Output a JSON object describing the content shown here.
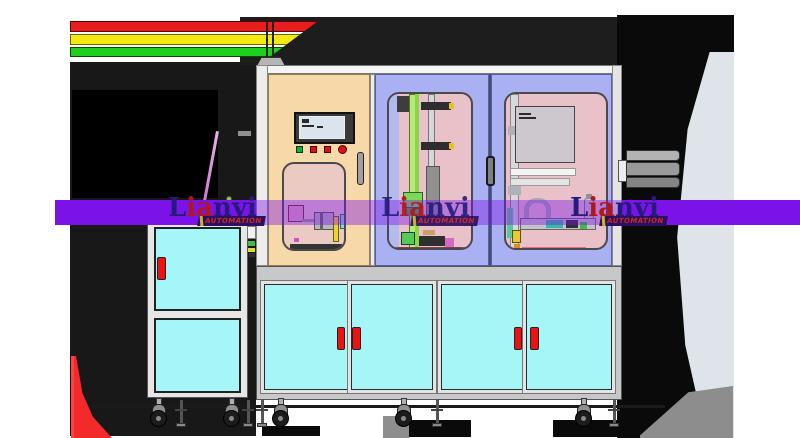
{
  "scene": {
    "type": "3D CAD render",
    "subject": "Industrial automation machine line with signal tower, HMI control panel, two equipment bays with inspection windows, lower cyan storage cabinets on casters, and a separate side cabinet cart",
    "background_color": "#ffffff"
  },
  "watermark": {
    "brand_l": "L",
    "brand_ia": "ia",
    "brand_nyi": "nyi",
    "subtitle": "AUTOMATION",
    "band_color": "#7b13e8",
    "letter_dark_color": "#241c7a",
    "letter_red_color": "#b01818",
    "subtitle_color": "#c82820"
  },
  "tower_light": {
    "red": "#e81e1e",
    "yellow": "#f2ea12",
    "green": "#1fcf1f"
  },
  "machine": {
    "control_panel_color": "#f7d9a9",
    "equipment_door_color": "#a9b1f2",
    "inspection_window_color": "#e8c2c8",
    "cabinet_door_color": "#a6f6f8",
    "handle_color": "#ee1111",
    "frame_color": "#e8e8e8",
    "hmi_buttons": [
      "green",
      "red",
      "red",
      "red"
    ]
  }
}
